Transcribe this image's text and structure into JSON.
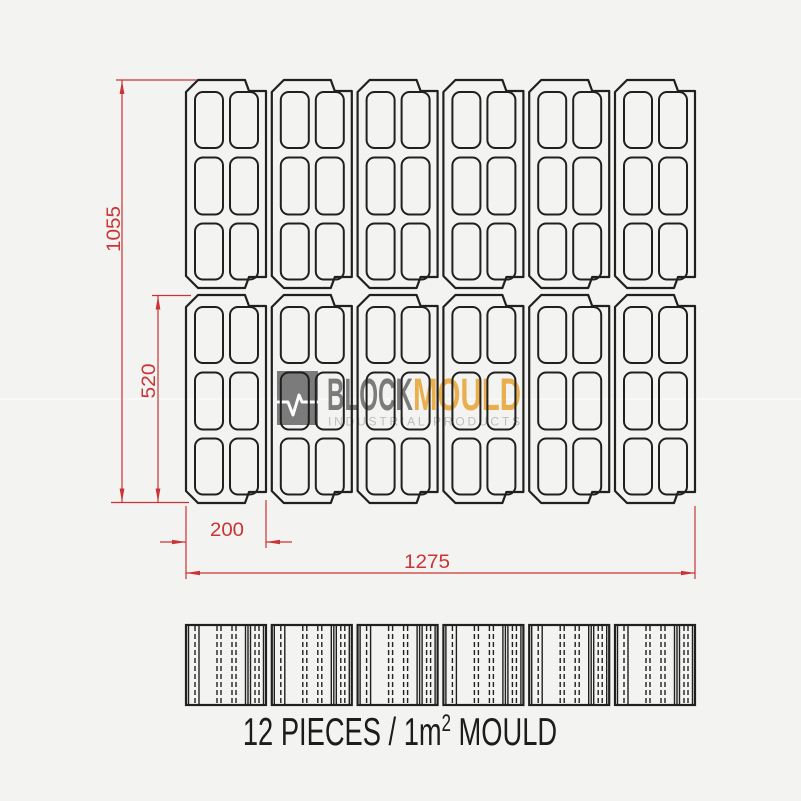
{
  "drawing": {
    "dimensions": {
      "total_height_mm": "1055",
      "block_height_mm": "520",
      "block_width_mm": "200",
      "total_width_mm": "1275"
    },
    "caption": {
      "prefix": "12 PIECES / 1m",
      "superscript": "2",
      "suffix": " MOULD"
    },
    "layout": {
      "pieces": 12,
      "plan_rows": 2,
      "plan_columns": 6,
      "cavities_per_piece": 6
    },
    "colors": {
      "dimension_red": "#cb3434",
      "line_black": "#202020",
      "background": "#f3f3f1"
    }
  },
  "logo": {
    "word1": "BLOCK",
    "word2": "MOULD",
    "subtitle": "INDUSTRIAL PRODUCTS",
    "icon": "pulse-icon",
    "colors": {
      "word1_gray": "#6f6f6f",
      "word2_orange": "#e9a83d",
      "subtitle_gray": "#b9b9b9"
    }
  }
}
